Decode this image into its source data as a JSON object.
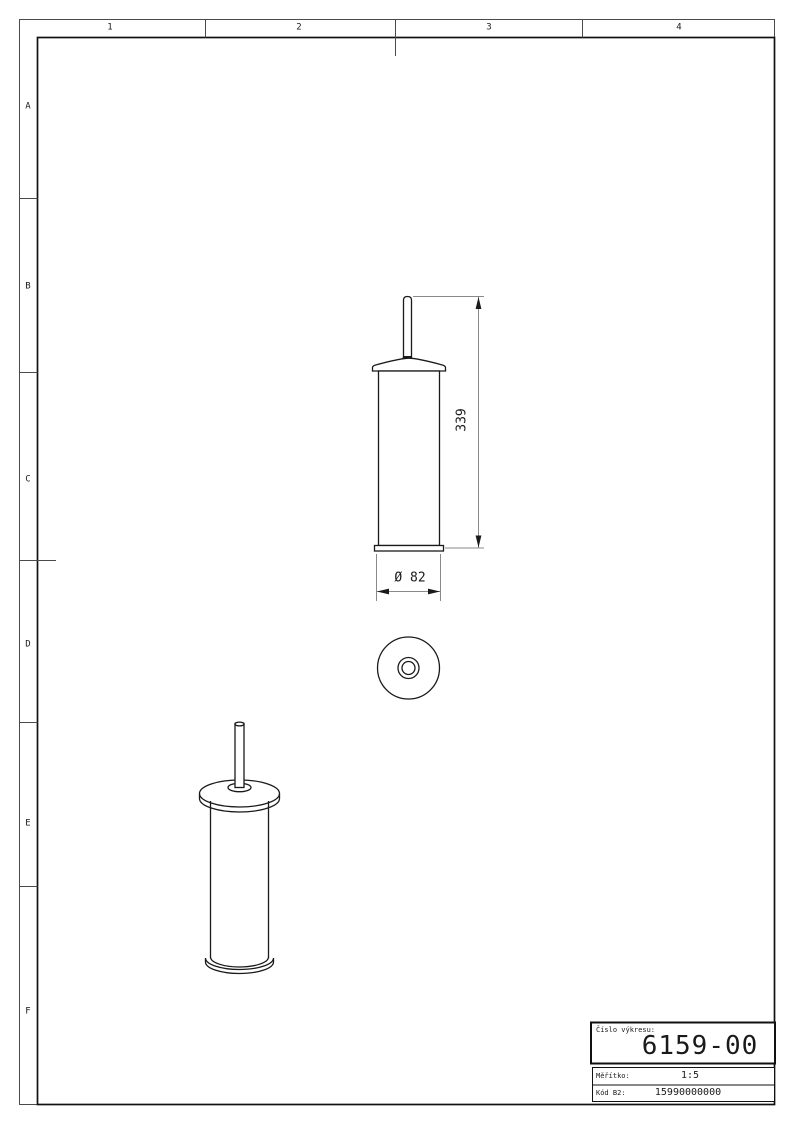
{
  "colors": {
    "background": "#ffffff",
    "object_line": "#1a1a1a",
    "dimension_line": "#8a8a8a",
    "text": "#1a1a1a"
  },
  "frame": {
    "columns": [
      "1",
      "2",
      "3",
      "4"
    ],
    "rows": [
      "A",
      "B",
      "C",
      "D",
      "E",
      "F"
    ]
  },
  "dimensions": {
    "height": "339",
    "diameter": "Ø 82"
  },
  "title_block": {
    "drawing_number_label": "Číslo výkresu:",
    "drawing_number": "6159-00",
    "scale_label": "Měřítko:",
    "scale": "1:5",
    "code_label": "Kód B2:",
    "code": "15990000000"
  }
}
